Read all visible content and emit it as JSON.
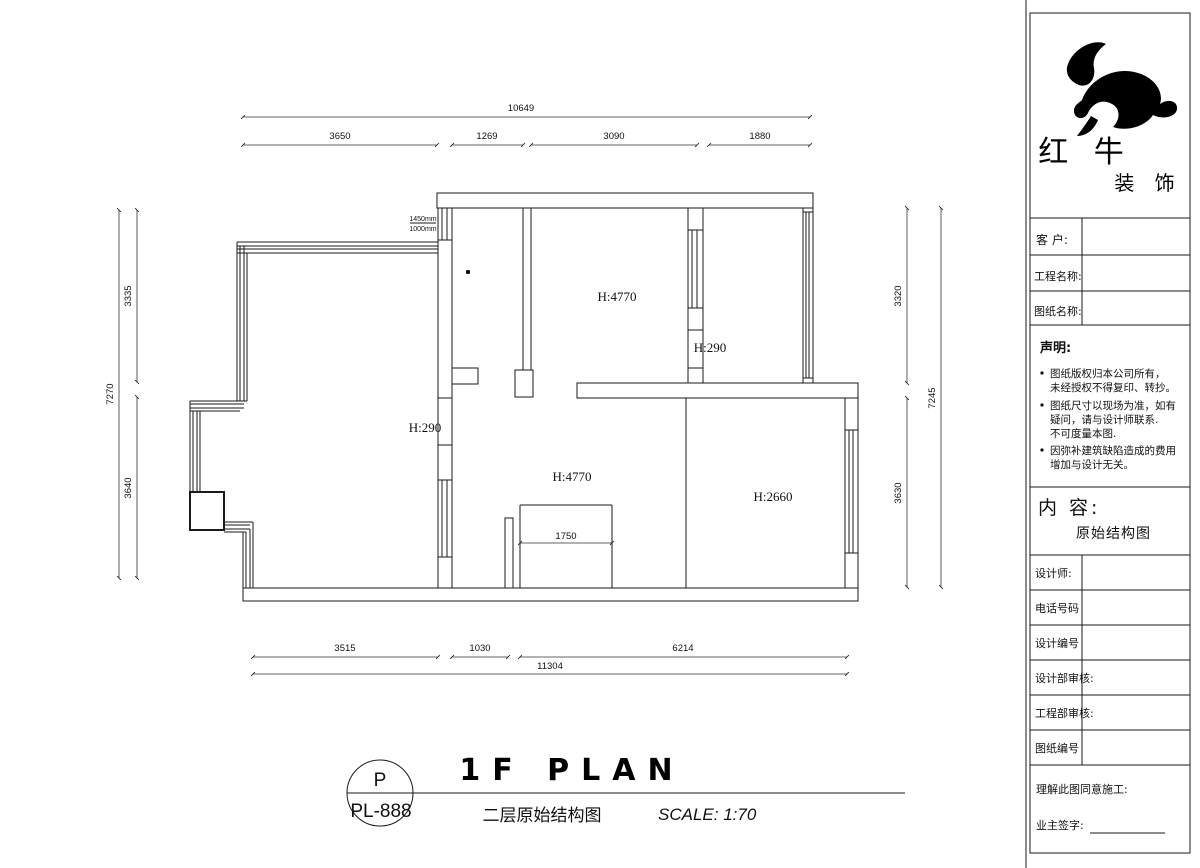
{
  "plan": {
    "dimensions": {
      "top": {
        "overall": "10649",
        "seg1": "3650",
        "seg2": "1269",
        "seg3": "3090",
        "seg4": "1880"
      },
      "bottom": {
        "seg1": "3515",
        "seg2": "1030",
        "seg3": "6214",
        "overall": "11304"
      },
      "left": {
        "overall": "7270",
        "seg_top": "3335",
        "seg_bottom": "3640"
      },
      "right": {
        "seg_top": "3320",
        "seg_bottom": "3630",
        "overall": "7245"
      }
    },
    "labels": {
      "top_room_height": "H:4770",
      "top_beam_height": "H:290",
      "left_beam_height": "H:290",
      "mid_room_height": "H:4770",
      "right_room_height": "H:2660",
      "inner_width": "1750",
      "window_width": "1450mm",
      "window_sill": "1000mm"
    }
  },
  "title_area": {
    "code_top": "P",
    "code_bottom": "PL-888",
    "title_en": "1F PLAN",
    "title_cn": "二层原始结构图",
    "scale": "SCALE: 1:70"
  },
  "title_block": {
    "brand": {
      "name_l1": "红 牛",
      "name_l2": "装 饰"
    },
    "fields": {
      "customer": "客  户:",
      "project_name": "工程名称:",
      "drawing_name": "图纸名称:"
    },
    "statement": {
      "heading": "声明:",
      "items": [
        {
          "lines": [
            "图纸版权归本公司所有，",
            "未经授权不得复印、转抄。"
          ]
        },
        {
          "lines": [
            "图纸尺寸以现场为准，如有",
            "疑问，请与设计师联系.",
            "不可度量本图."
          ]
        },
        {
          "lines": [
            "因弥补建筑缺陷造成的费用",
            "增加与设计无关。"
          ]
        }
      ]
    },
    "content": {
      "heading": "内 容:",
      "value": "原始结构图"
    },
    "rows": {
      "designer": "设计师:",
      "phone": "电话号码",
      "design_no": "设计编号",
      "design_review": "设计部审核:",
      "engineering_review": "工程部审核:",
      "drawing_no": "图纸编号"
    },
    "footer": {
      "agree": "理解此图同意施工:",
      "owner_sign": "业主签字:"
    }
  }
}
